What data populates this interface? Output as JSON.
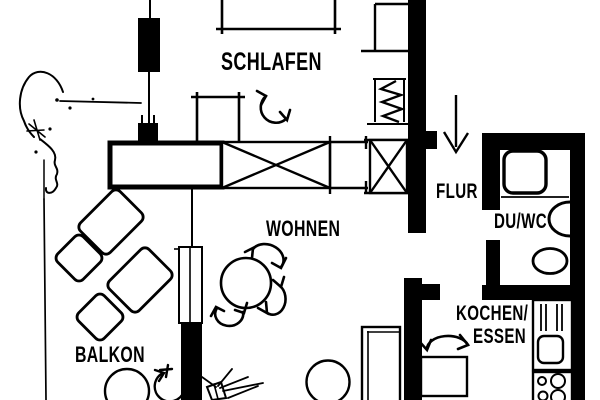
{
  "plan": {
    "type": "apartment-floorplan",
    "colors": {
      "ink": "#000000",
      "paper": "#ffffff"
    },
    "rooms": {
      "schlafen": {
        "label": "SCHLAFEN"
      },
      "wohnen": {
        "label": "WOHNEN"
      },
      "flur": {
        "label": "FLUR"
      },
      "duwc": {
        "label": "DU/WC"
      },
      "kochen_essen": {
        "label_line1": "KOCHEN/",
        "label_line2": "ESSEN"
      },
      "balkon": {
        "label": "BALKON"
      }
    },
    "furniture": {
      "bed": "bed",
      "wardrobe": "wardrobe",
      "radiator": "radiator",
      "shower": "shower",
      "wc": "wc",
      "washbasin": "washbasin",
      "sink_unit": "sink-unit",
      "cooktop": "cooktop",
      "dining_table": "dining-table",
      "round_table": "round-table",
      "chaise_lounge": "chaise-lounge",
      "plant": "plant",
      "entrance_arrow": "entrance-arrow"
    }
  }
}
